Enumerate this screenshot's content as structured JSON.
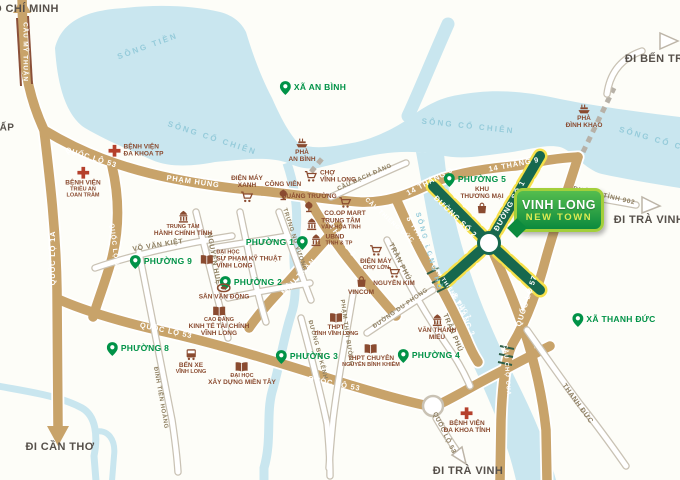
{
  "meta": {
    "width": 680,
    "height": 480,
    "subject": "Vinh Long New Town location map"
  },
  "colors": {
    "water": "#c9e6ef",
    "land": "#fdfdf8",
    "road_tan": "#c8a36a",
    "road_white": "#ffffff",
    "road_casing": "#c9c2b4",
    "green_road": "#17684e",
    "green_road_stripe": "#f6e04a",
    "place_green": "#009247",
    "poi_brown": "#8a4b30",
    "hospital_red": "#b5402c",
    "river_label": "#95cbda",
    "dest_text": "#56504a",
    "billboard_border": "#a3cf3b",
    "billboard_fill": "#0c8a3e",
    "billboard_subtitle": "#dcea52"
  },
  "billboard": {
    "line1": "VINH LONG",
    "line2": "NEW TOWN"
  },
  "labels": [
    {
      "n": "dest-ho-chi-minh",
      "t": "dest",
      "x": 26,
      "y": 9,
      "tx": "Ồ CHÍ MINH"
    },
    {
      "n": "dest-di-can-tho",
      "t": "dest",
      "x": 60,
      "y": 447,
      "tx": "ĐI CẦN THƠ"
    },
    {
      "n": "dest-di-ben-tre",
      "t": "dest",
      "x": 658,
      "y": 59,
      "tx": "ĐI BẾN TRE"
    },
    {
      "n": "dest-di-tra-vinh-east",
      "t": "dest",
      "x": 649,
      "y": 220,
      "tx": "ĐI TRÀ VINH"
    },
    {
      "n": "dest-di-tra-vinh-south",
      "t": "dest",
      "x": 468,
      "y": 471,
      "tx": "ĐI TRÀ VINH"
    },
    {
      "n": "dest-ap",
      "t": "dest",
      "x": 7,
      "y": 128,
      "tx": "ẤP",
      "fs": 10
    },
    {
      "n": "river-song-tien",
      "t": "river",
      "x": 148,
      "y": 47,
      "r": -20,
      "tx": "SÔNG TIỀN"
    },
    {
      "n": "river-song-co-chien-1",
      "t": "river",
      "x": 212,
      "y": 139,
      "r": 18,
      "tx": "SÔNG CỔ CHIÊN"
    },
    {
      "n": "river-song-co-chien-2",
      "t": "river",
      "x": 468,
      "y": 127,
      "r": 6,
      "tx": "SÔNG CỔ CHIÊN"
    },
    {
      "n": "river-song-co-chien-3",
      "t": "river",
      "x": 664,
      "y": 143,
      "r": 16,
      "tx": "SÔNG CỔ CHIÊN"
    },
    {
      "n": "river-song-long-ho",
      "t": "river",
      "x": 428,
      "y": 252,
      "r": 74,
      "tx": "SÔNG LONG HỒ",
      "fs": 7
    },
    {
      "n": "road-cau-my-thuan",
      "t": "roadTan",
      "x": 25,
      "y": 52,
      "r": 90,
      "tx": "CẦU MỸ THUẬN",
      "fs": 6.5
    },
    {
      "n": "road-quoc-lo-53-nw",
      "t": "roadTan",
      "x": 91,
      "y": 158,
      "r": 17,
      "tx": "QUỐC LỘ 53"
    },
    {
      "n": "road-pham-hung",
      "t": "roadTan",
      "x": 193,
      "y": 182,
      "r": 8,
      "tx": "PHẠM HÙNG"
    },
    {
      "n": "road-quoc-lo-1a",
      "t": "roadTan",
      "x": 53,
      "y": 258,
      "r": -90,
      "tx": "QUỐC LỘ 1A"
    },
    {
      "n": "road-quoc-lo-53-mid",
      "t": "roadTan",
      "x": 114,
      "y": 247,
      "r": 83,
      "tx": "QUỐC LỘ 53",
      "fs": 6.5
    },
    {
      "n": "road-14-thang-9-w",
      "t": "roadTan",
      "x": 430,
      "y": 182,
      "r": -28,
      "tx": "14 THÁNG 9"
    },
    {
      "n": "road-14-thang-9-e",
      "t": "roadTan",
      "x": 514,
      "y": 165,
      "r": -11,
      "tx": "14 THÁNG 9"
    },
    {
      "n": "road-2-thang-9",
      "t": "roadTan",
      "x": 340,
      "y": 238,
      "r": 52,
      "tx": "2 THÁNG 9"
    },
    {
      "n": "road-mau-than",
      "t": "roadTan",
      "x": 299,
      "y": 277,
      "r": -47,
      "tx": "MẬU THÂN"
    },
    {
      "n": "road-quoc-lo-53-s1",
      "t": "roadTan",
      "x": 166,
      "y": 331,
      "r": 12,
      "tx": "QUỐC LỘ 53"
    },
    {
      "n": "road-quoc-lo-53-s2",
      "t": "roadTan",
      "x": 334,
      "y": 384,
      "r": 11,
      "tx": "QUỐC LỘ 53"
    },
    {
      "n": "road-8-thang-3-n",
      "t": "roadTan",
      "x": 420,
      "y": 237,
      "r": 58,
      "tx": "8 THÁNG 3"
    },
    {
      "n": "road-8-thang-3-s",
      "t": "roadTan",
      "x": 463,
      "y": 315,
      "r": 66,
      "tx": "8 THÁNG 3"
    },
    {
      "n": "road-quoc-lo-57",
      "t": "roadTan",
      "x": 527,
      "y": 301,
      "r": -72,
      "tx": "QUỐC LỘ 57"
    },
    {
      "n": "bridge-cau-thieng-duc",
      "t": "roadTan",
      "x": 389,
      "y": 221,
      "r": 42,
      "tx": "CẦU THIỀNG ĐỨC",
      "fs": 6
    },
    {
      "n": "bridge-cau-thieng-duc-2",
      "t": "roadTan",
      "x": 451,
      "y": 292,
      "r": 55,
      "tx": "CẦU THIỀNG ĐỨC 2",
      "fs": 5.5
    },
    {
      "n": "bridge-cau-cho-cua",
      "t": "roadTan",
      "x": 506,
      "y": 370,
      "r": 86,
      "tx": "CẦU CHỢ CUA",
      "fs": 6
    },
    {
      "n": "road-duong-so-1",
      "t": "roadTan",
      "x": 510,
      "y": 206,
      "r": -61,
      "tx": "ĐƯỜNG SỐ 1"
    },
    {
      "n": "road-duong-so-2",
      "t": "roadTan",
      "x": 455,
      "y": 217,
      "r": 44,
      "tx": "ĐƯỜNG SỐ 2"
    },
    {
      "n": "road-vo-van-kiet",
      "t": "roadWhite",
      "x": 158,
      "y": 246,
      "r": -9,
      "tx": "VÕ VĂN KIỆT"
    },
    {
      "n": "road-nguyen-hue",
      "t": "roadWhite",
      "x": 213,
      "y": 259,
      "r": 80,
      "tx": "NGUYỄN HUỆ"
    },
    {
      "n": "road-trung-nu-vuong",
      "t": "roadWhite",
      "x": 294,
      "y": 240,
      "r": 72,
      "tx": "TRƯNG NỮ VƯƠNG",
      "fs": 6
    },
    {
      "n": "road-tran-phu-n",
      "t": "roadWhite",
      "x": 399,
      "y": 262,
      "r": 63,
      "tx": "TRẦN PHÚ"
    },
    {
      "n": "road-tran-phu-s",
      "t": "roadWhite",
      "x": 452,
      "y": 333,
      "r": 67,
      "tx": "TRẦN PHÚ"
    },
    {
      "n": "road-dinh-tien-hoang",
      "t": "roadWhite",
      "x": 160,
      "y": 398,
      "r": 80,
      "tx": "ĐINH TIÊN HOÀNG",
      "fs": 6
    },
    {
      "n": "road-duong-bo-kenh",
      "t": "roadWhite",
      "x": 317,
      "y": 350,
      "r": 75,
      "tx": "ĐƯỜNG BỜ KÊNH",
      "fs": 6
    },
    {
      "n": "road-p  ham-thai-buong",
      "t": "roadWhite",
      "x": 346,
      "y": 333,
      "r": 82,
      "tx": "PHẠM THÁI BƯỜNG",
      "fs": 6
    },
    {
      "n": "road-duong-du-phong",
      "t": "roadWhite",
      "x": 401,
      "y": 309,
      "r": -35,
      "tx": "ĐƯỜNG DU PHONG",
      "fs": 6
    },
    {
      "n": "bridge-cau-bach-dang",
      "t": "roadWhite",
      "x": 365,
      "y": 178,
      "r": -24,
      "tx": "CẦU BẠCH ĐẰNG",
      "fs": 6
    },
    {
      "n": "road-thanh-duc",
      "t": "roadWhite",
      "x": 577,
      "y": 404,
      "r": 54,
      "tx": "THANH ĐỨC"
    },
    {
      "n": "road-duong-tinh-902",
      "t": "roadWhite",
      "x": 604,
      "y": 196,
      "r": 13,
      "tx": "ĐƯỜNG TỈNH 902",
      "fs": 6.5
    },
    {
      "n": "road-quoc-lo-53-future",
      "t": "roadWhite",
      "x": 444,
      "y": 433,
      "r": 64,
      "tx": "QUỐC LỘ 53",
      "fs": 6.5
    },
    {
      "n": "place-xa-an-binh",
      "t": "place",
      "x": 313,
      "y": 88,
      "tx": "XÃ AN BÌNH"
    },
    {
      "n": "place-phuong-5",
      "t": "place",
      "x": 475,
      "y": 180,
      "tx": "PHƯỜNG 5"
    },
    {
      "n": "place-phuong-1",
      "t": "place",
      "x": 277,
      "y": 243,
      "tx": "PHƯỜNG 1",
      "pr": 1
    },
    {
      "n": "place-phuong-9",
      "t": "place",
      "x": 161,
      "y": 262,
      "tx": "PHƯỜNG 9"
    },
    {
      "n": "place-phuong-2",
      "t": "place",
      "x": 251,
      "y": 283,
      "tx": "PHƯỜNG 2"
    },
    {
      "n": "place-phuong-8",
      "t": "place",
      "x": 138,
      "y": 349,
      "tx": "PHƯỜNG 8"
    },
    {
      "n": "place-phuong-3",
      "t": "place",
      "x": 307,
      "y": 357,
      "tx": "PHƯỜNG 3"
    },
    {
      "n": "place-phuong-4",
      "t": "place",
      "x": 429,
      "y": 356,
      "tx": "PHƯỜNG 4"
    },
    {
      "n": "place-xa-thanh-duc",
      "t": "place",
      "x": 614,
      "y": 320,
      "tx": "XÃ THANH ĐỨC"
    },
    {
      "n": "poi-benh-vien-da-khoa-tp",
      "t": "poi",
      "x": 136,
      "y": 151,
      "ip": "l",
      "icon": "cross",
      "lines": [
        {
          "t": "BỆNH VIỆN"
        },
        {
          "t": "ĐA KHOA TP"
        }
      ]
    },
    {
      "n": "poi-benh-vien-trieu-an",
      "t": "poi",
      "x": 83,
      "y": 183,
      "ip": "t",
      "icon": "cross",
      "lines": [
        {
          "t": "BỆNH VIỆN"
        },
        {
          "t": "TRIỀU AN",
          "s": 1
        },
        {
          "t": "LOAN TRÂM",
          "s": 1
        }
      ]
    },
    {
      "n": "poi-trung-tam-hanh-chinh-tinh",
      "t": "poi",
      "x": 183,
      "y": 224,
      "ip": "t",
      "icon": "gov",
      "lines": [
        {
          "t": "TRUNG TÂM",
          "s": 1
        },
        {
          "t": "HÀNH CHÍNH TỈNH"
        }
      ]
    },
    {
      "n": "poi-dien-may-xanh",
      "t": "poi",
      "x": 247,
      "y": 189,
      "ip": "b",
      "icon": "cart",
      "lines": [
        {
          "t": "ĐIỆN MÁY"
        },
        {
          "t": "XANH"
        }
      ]
    },
    {
      "n": "poi-cong-vien",
      "t": "poi",
      "x": 283,
      "y": 191,
      "ip": "b",
      "icon": "park",
      "lines": [
        {
          "t": "CÔNG VIÊN"
        }
      ]
    },
    {
      "n": "poi-cho-vinh-long",
      "t": "poi",
      "x": 330,
      "y": 177,
      "ip": "l",
      "icon": "cart",
      "lines": [
        {
          "t": "CHỢ"
        },
        {
          "t": "VĨNH LONG"
        }
      ]
    },
    {
      "n": "poi-pha-an-binh",
      "t": "poi",
      "x": 302,
      "y": 151,
      "ip": "t",
      "icon": "boat",
      "lines": [
        {
          "t": "PHÀ"
        },
        {
          "t": "AN BÌNH"
        }
      ]
    },
    {
      "n": "poi-quang-truong",
      "t": "poi",
      "x": 309,
      "y": 203,
      "ip": "b",
      "icon": "park",
      "lines": [
        {
          "t": "QUẢNG TRƯỜNG"
        }
      ]
    },
    {
      "n": "poi-coop-mart",
      "t": "poi",
      "x": 345,
      "y": 207,
      "ip": "t",
      "icon": "cart",
      "lines": [
        {
          "t": "CO.OP MART"
        }
      ]
    },
    {
      "n": "poi-trung-tam-van-hoa",
      "t": "poi",
      "x": 333,
      "y": 224,
      "ip": "l",
      "icon": "gov",
      "lines": [
        {
          "t": "TRUNG TÂM"
        },
        {
          "t": "VĂN HÓA TỈNH",
          "s": 1
        }
      ]
    },
    {
      "n": "poi-ubnd",
      "t": "poi",
      "x": 331,
      "y": 240,
      "ip": "l",
      "icon": "gov",
      "lines": [
        {
          "t": "UBND"
        },
        {
          "t": "TỈNH & TP",
          "s": 1
        }
      ]
    },
    {
      "n": "poi-dien-may-cho-lon",
      "t": "poi",
      "x": 376,
      "y": 258,
      "ip": "t",
      "icon": "cart",
      "lines": [
        {
          "t": "ĐIỆN MÁY"
        },
        {
          "t": "CHỢ LỚN",
          "s": 1
        }
      ]
    },
    {
      "n": "poi-nguyen-kim",
      "t": "poi",
      "x": 394,
      "y": 277,
      "ip": "t",
      "icon": "cart",
      "lines": [
        {
          "t": "NGUYỄN KIM"
        }
      ]
    },
    {
      "n": "poi-vincom",
      "t": "poi",
      "x": 361,
      "y": 286,
      "ip": "t",
      "icon": "bag",
      "lines": [
        {
          "t": "VINCOM"
        }
      ]
    },
    {
      "n": "poi-khu-thuong-mai",
      "t": "poi",
      "x": 482,
      "y": 200,
      "ip": "b",
      "icon": "bag",
      "lines": [
        {
          "t": "KHU"
        },
        {
          "t": "THƯƠNG MẠI"
        }
      ]
    },
    {
      "n": "poi-san-van-dong",
      "t": "poi",
      "x": 224,
      "y": 292,
      "ip": "t",
      "icon": "stadium",
      "lines": [
        {
          "t": "SÂN VẬN ĐỘNG"
        }
      ]
    },
    {
      "n": "poi-cao-dang-kinh-te",
      "t": "poi",
      "x": 219,
      "y": 322,
      "ip": "t",
      "icon": "book",
      "lines": [
        {
          "t": "CAO ĐẲNG",
          "s": 1
        },
        {
          "t": "KINH TẾ TÀI CHÍNH"
        },
        {
          "t": "VĨNH LONG"
        }
      ]
    },
    {
      "n": "poi-dh-su-pham-ky-thuat",
      "t": "poi",
      "x": 241,
      "y": 260,
      "ip": "l",
      "icon": "book",
      "lines": [
        {
          "t": "ĐẠI HỌC",
          "s": 1
        },
        {
          "t": "SƯ PHẠM KỸ THUẬT"
        },
        {
          "t": "VĨNH LONG"
        }
      ]
    },
    {
      "n": "poi-ben-xe-vinh-long",
      "t": "poi",
      "x": 191,
      "y": 362,
      "ip": "t",
      "icon": "bus",
      "lines": [
        {
          "t": "BẾN XE"
        },
        {
          "t": "VĨNH LONG",
          "s": 1
        }
      ]
    },
    {
      "n": "poi-dh-xay-dung-mien-tay",
      "t": "poi",
      "x": 242,
      "y": 374,
      "ip": "t",
      "icon": "book",
      "lines": [
        {
          "t": "ĐẠI HỌC",
          "s": 1
        },
        {
          "t": "XÂY DỰNG MIỀN TÂY"
        }
      ]
    },
    {
      "n": "poi-thpt-vinh-long",
      "t": "poi",
      "x": 336,
      "y": 325,
      "ip": "t",
      "icon": "book",
      "lines": [
        {
          "t": "THPT"
        },
        {
          "t": "TỈNH VĨNH LONG",
          "s": 1
        }
      ]
    },
    {
      "n": "poi-thpt-chuyen-nbk",
      "t": "poi",
      "x": 371,
      "y": 356,
      "ip": "t",
      "icon": "book",
      "lines": [
        {
          "t": "THPT CHUYÊN"
        },
        {
          "t": "NGUYỄN BỈNH KHIÊM",
          "s": 1
        }
      ]
    },
    {
      "n": "poi-van-thanh-mieu",
      "t": "poi",
      "x": 437,
      "y": 328,
      "ip": "t",
      "icon": "gov",
      "lines": [
        {
          "t": "VĂN THÁNH"
        },
        {
          "t": "MIẾU"
        }
      ]
    },
    {
      "n": "poi-benh-vien-da-khoa-tinh",
      "t": "poi",
      "x": 467,
      "y": 421,
      "ip": "t",
      "icon": "cross",
      "lines": [
        {
          "t": "BỆNH VIỆN"
        },
        {
          "t": "ĐA KHOA TỈNH"
        }
      ]
    },
    {
      "n": "poi-pha-dinh-khao",
      "t": "poi",
      "x": 584,
      "y": 117,
      "ip": "t",
      "icon": "boat",
      "lines": [
        {
          "t": "PHÀ"
        },
        {
          "t": "ĐÌNH KHAO"
        }
      ]
    }
  ]
}
